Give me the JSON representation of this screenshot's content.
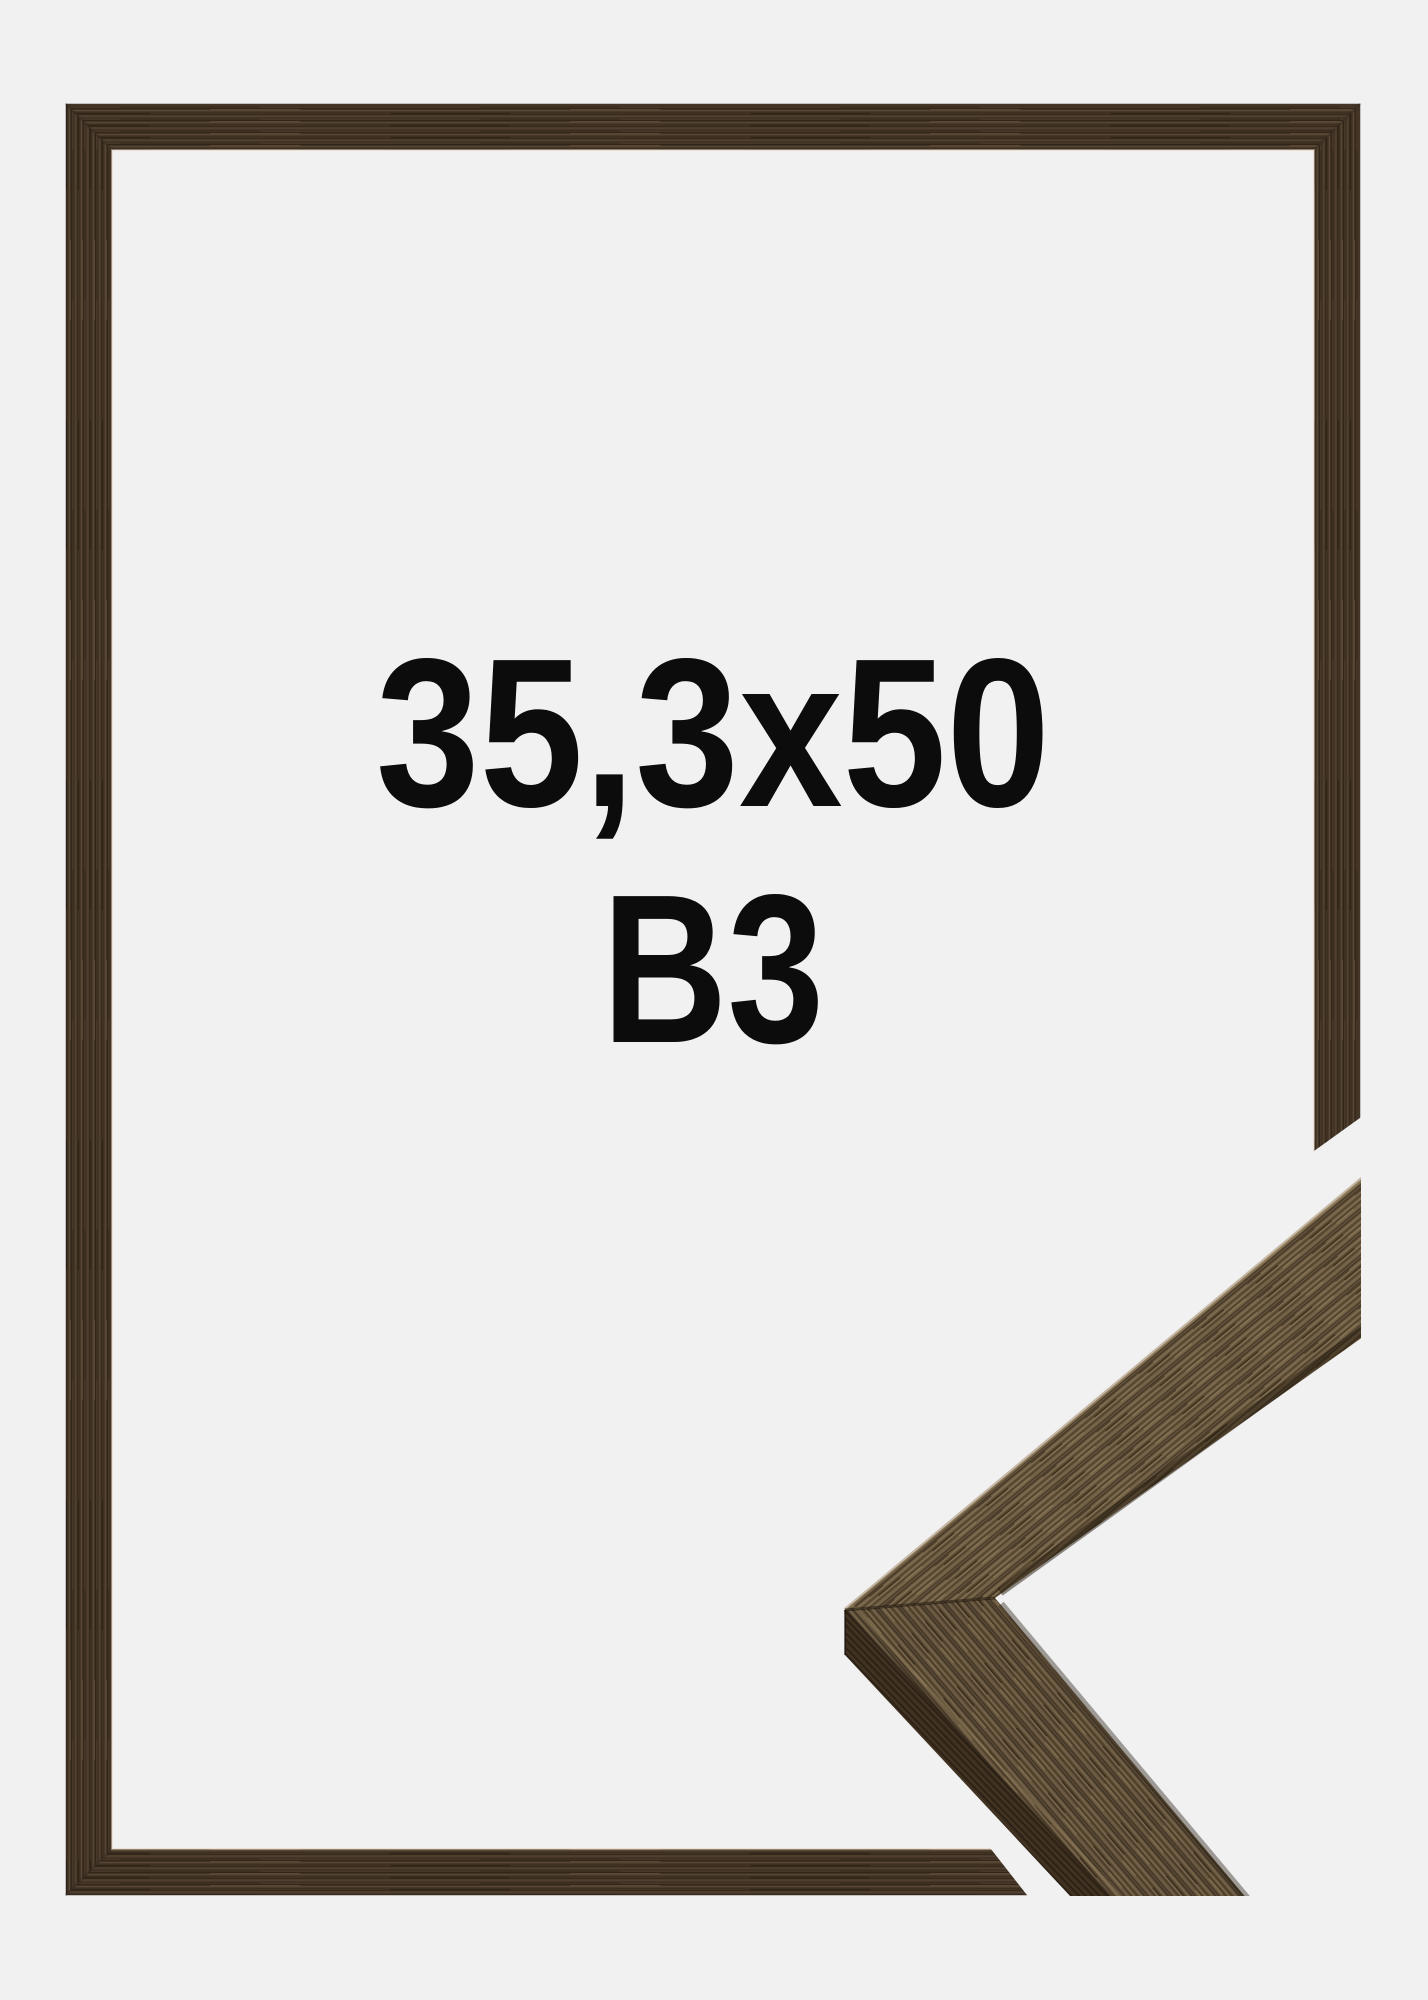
{
  "product_image": {
    "description": "Front view of a dark walnut wooden picture frame on a light grey studio background, with a 3D mitered corner profile sample overlapping the bottom-right edge",
    "size_label": "35,3x50",
    "format_label": "B3",
    "colors": {
      "background": "#f1f1f2",
      "text": "#0c0c0c",
      "frame_wood_base": "#47382a",
      "frame_wood_dark_streak": "#2b2012",
      "frame_wood_light_streak": "#5d4a35",
      "corner_wood_base": "#6f5e46",
      "corner_wood_lower_base": "#655540",
      "corner_wood_side_face": "#3a2d1e",
      "corner_highlight": "#a28c69",
      "corner_shadow": "#241b0e",
      "inner_edge_glint": "#e3d0bd"
    }
  }
}
